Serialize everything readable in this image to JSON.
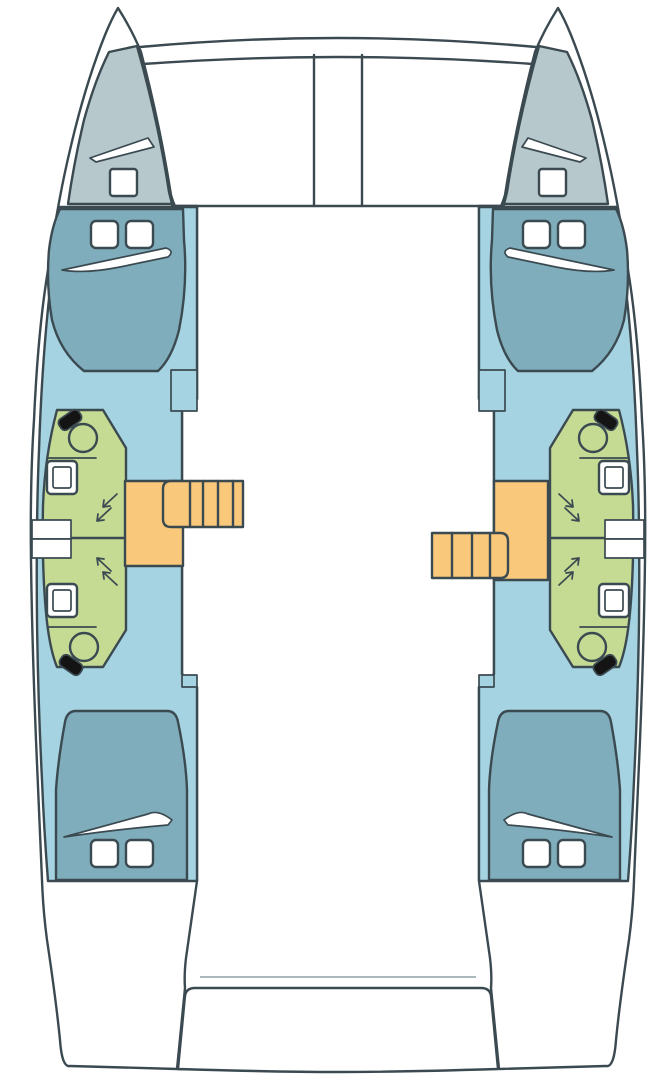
{
  "colors": {
    "background": "#ffffff",
    "outline": "#3b4a51",
    "hull_interior": "#a5d3e1",
    "bed": "#7fadbc",
    "foredeck": "#b6c8cb",
    "bathroom": "#c5da93",
    "stairs": "#f9c87b",
    "fixture_black": "#141414",
    "white": "#ffffff",
    "faint_line": "#8fa0a6"
  },
  "diagram": {
    "type": "floorplan",
    "subject": "catamaran lower-deck layout, top view, bows up",
    "hulls": 2,
    "double_berths": 4,
    "bathrooms": 4,
    "toilets": 4,
    "sinks": 4,
    "shower_corners": 4,
    "companionway_stairs": 2,
    "trampoline_bays": 2,
    "area_meaning": {
      "hull_interior": "hull cabin sole",
      "bed": "double berth with two pillows and turned-down sheet",
      "foredeck": "forepeak locker with hatch",
      "bathroom": "head / shower compartment",
      "stairs": "companionway steps down from saloon",
      "white_center": "bridgedeck (saloon not drawn) and aft cockpit"
    }
  }
}
